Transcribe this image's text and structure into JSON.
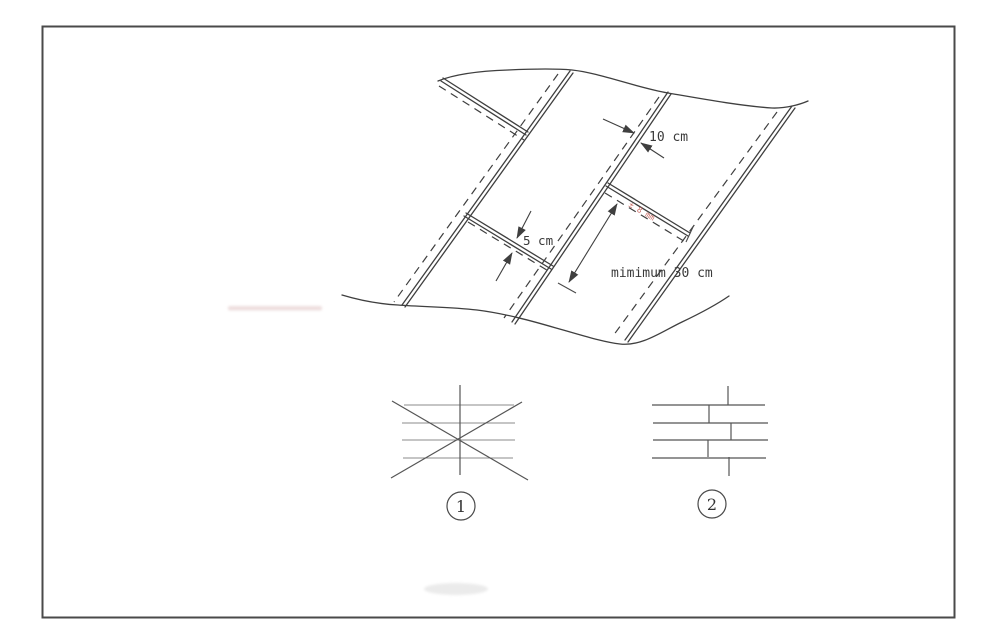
{
  "page": {
    "background": "#ffffff",
    "border_color": "#4a4a4a",
    "ink_color": "#3f3f3f",
    "red_color": "#c0524a"
  },
  "figure": {
    "dimension_labels": {
      "top_overlap": "10 cm",
      "left_overlap": "5 cm",
      "min_spacing": "mimimum 30 cm"
    },
    "red_annotation": "± 8 mm",
    "options": {
      "option1": "1",
      "option2": "2"
    }
  }
}
